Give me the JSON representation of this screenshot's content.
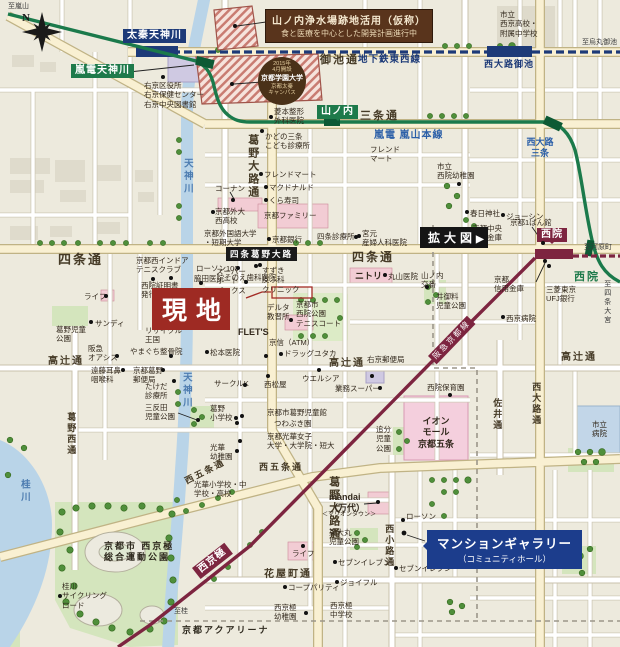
{
  "compass": {
    "n": "N"
  },
  "boxes": {
    "site": "現地",
    "enlarge_label": "拡大図",
    "enlarge_arrow": "▶",
    "intersection": "四条葛野大路",
    "info_line1": "山ノ内浄水場跡地活用（仮称）",
    "info_line2": "食と医療を中心とした開発計画進行中",
    "gallery_line1": "マンションギャラリー",
    "gallery_line2": "（コミュニティホール）"
  },
  "campus": {
    "l1": "2015年",
    "l2": "4月開設",
    "l3": "京都学園大学",
    "l4": "京都太秦",
    "l5": "キャンパス"
  },
  "lines": {
    "subway": "地下鉄東西線",
    "randen": "嵐電 嵐山本線",
    "hankyu": "阪急京都線"
  },
  "labels": [
    {
      "n": "dir-to-arashiyama",
      "t": "至嵐山",
      "x": 8,
      "y": 2,
      "c": "dir"
    },
    {
      "n": "station-uzumasa-tenjingawa",
      "t": "太秦天神川",
      "x": 123,
      "y": 29,
      "c": "station-navy"
    },
    {
      "n": "station-randen-tenjingawa",
      "t": "嵐電天神川",
      "x": 71,
      "y": 64,
      "c": "station-green"
    },
    {
      "n": "poi-ukyo-ward-office",
      "t": "右京区役所\n右京保健センター\n右京中央図書館",
      "x": 144,
      "y": 81,
      "c": "poi",
      "d": [
        163,
        77
      ]
    },
    {
      "n": "poi-saikyo-highschool",
      "t": "市立\n西京高校・\n附属中学校",
      "x": 500,
      "y": 10,
      "c": "poi"
    },
    {
      "n": "dir-to-karasuma-oike",
      "t": "至烏丸御池",
      "x": 582,
      "y": 38,
      "c": "dir"
    },
    {
      "n": "street-oike-dori",
      "t": "御池通",
      "x": 320,
      "y": 54,
      "c": "street",
      "s": 11
    },
    {
      "n": "rail-subway-tozai-label",
      "t": "地下鉄東西線",
      "x": 358,
      "y": 55,
      "c": "subway-text"
    },
    {
      "n": "station-nishioji-oike",
      "t": "西大路御池",
      "x": 484,
      "y": 59,
      "c": "subway-text",
      "s": 9
    },
    {
      "n": "street-sanjo-dori",
      "t": "三条通",
      "x": 360,
      "y": 110,
      "c": "street",
      "s": 11
    },
    {
      "n": "station-yamanouchi",
      "t": "山ノ内",
      "x": 317,
      "y": 105,
      "c": "station-green pt-down"
    },
    {
      "n": "rail-randen-line-label",
      "t": "嵐電 嵐山本線",
      "x": 374,
      "y": 130,
      "c": "rail-blue"
    },
    {
      "n": "station-nishioji-sanjo",
      "t": "西大路\n三条",
      "x": 520,
      "y": 137,
      "c": "blue2",
      "w": 40
    },
    {
      "n": "river-tenjingawa-upper",
      "t": "天神川",
      "x": 180,
      "y": 158,
      "c": "river",
      "v": 1
    },
    {
      "n": "poi-hishimoto-seikei",
      "t": "菱本整形\n外科医院",
      "x": 274,
      "y": 107,
      "c": "poi",
      "d": [
        271,
        117
      ]
    },
    {
      "n": "poi-kadono-sanjo-kids-clinic",
      "t": "かどの三条\nこども診療所",
      "x": 265,
      "y": 132,
      "c": "poi",
      "d": [
        262,
        131
      ]
    },
    {
      "n": "poi-friend-mart-1",
      "t": "フレンド\nマート",
      "x": 370,
      "y": 145,
      "c": "poi"
    },
    {
      "n": "poi-saiin-city-kindergarten",
      "t": "市立\n西院幼稚園",
      "x": 437,
      "y": 162,
      "c": "poi",
      "d": [
        459,
        184
      ]
    },
    {
      "n": "street-kadono-oji-upper",
      "t": "葛野大路通",
      "x": 245,
      "y": 134,
      "c": "street",
      "v": 1,
      "s": 11
    },
    {
      "n": "poi-konan",
      "t": "コーナン",
      "x": 215,
      "y": 184,
      "c": "poi",
      "d": [
        233,
        200
      ]
    },
    {
      "n": "poi-friend-mart-2",
      "t": "フレンドマート",
      "x": 264,
      "y": 170,
      "c": "poi",
      "d": [
        261,
        174
      ]
    },
    {
      "n": "poi-mcdonalds",
      "t": "マクドナルド",
      "x": 269,
      "y": 183,
      "c": "poi",
      "d": [
        266,
        187
      ]
    },
    {
      "n": "poi-kura-sushi",
      "t": "くら寿司",
      "x": 269,
      "y": 196,
      "c": "poi",
      "d": [
        266,
        200
      ]
    },
    {
      "n": "poi-kasuga-shrine",
      "t": "春日神社",
      "x": 470,
      "y": 209,
      "c": "poi",
      "d": [
        467,
        212
      ]
    },
    {
      "n": "poi-joshin",
      "t": "ジョーシン",
      "x": 506,
      "y": 212,
      "c": "poi",
      "d": [
        503,
        215
      ]
    },
    {
      "n": "poi-kyoto-family",
      "t": "京都ファミリー",
      "x": 264,
      "y": 211,
      "c": "poi"
    },
    {
      "n": "poi-kyoto-gaidai-nishi-hs",
      "t": "京都外大\n西高校",
      "x": 215,
      "y": 207,
      "c": "poi",
      "d": [
        213,
        212
      ]
    },
    {
      "n": "poi-kyoto-univ-foreign-studies",
      "t": "京都外国語大学\n・短期大学",
      "x": 204,
      "y": 229,
      "c": "poi"
    },
    {
      "n": "poi-kyoto-bank",
      "t": "京都銀行",
      "x": 272,
      "y": 235,
      "c": "poi",
      "d": [
        269,
        239
      ]
    },
    {
      "n": "poi-shijo-clinic",
      "t": "四条診療所",
      "x": 317,
      "y": 232,
      "c": "poi",
      "d": [
        356,
        237
      ]
    },
    {
      "n": "poi-miyamoto-maternity",
      "t": "宮元\n産婦人科医院",
      "x": 362,
      "y": 229,
      "c": "poi",
      "d": [
        359,
        236
      ]
    },
    {
      "n": "poi-kyoto-chuo-shinkin",
      "t": "京都中央\n信用金庫",
      "x": 472,
      "y": 224,
      "c": "poi"
    },
    {
      "n": "poi-kyoto-ichibankan",
      "t": "京都1ばん館",
      "x": 510,
      "y": 218,
      "c": "poi",
      "d": [
        543,
        243
      ]
    },
    {
      "n": "street-shijo-dori-west",
      "t": "四条通",
      "x": 58,
      "y": 252,
      "c": "street",
      "s": 13
    },
    {
      "n": "street-shijo-dori-east",
      "t": "四条通",
      "x": 352,
      "y": 250,
      "c": "street",
      "s": 12
    },
    {
      "n": "dir-to-kawaramachi",
      "t": "至河原町",
      "x": 584,
      "y": 243,
      "c": "dir"
    },
    {
      "n": "station-saiin-hankyu",
      "t": "西院",
      "x": 537,
      "y": 228,
      "c": "station-maroon pt-down"
    },
    {
      "n": "station-saiin-randen",
      "t": "西院",
      "x": 574,
      "y": 271,
      "c": "green-text"
    },
    {
      "n": "dir-to-shijo-omiya",
      "t": "至四条大宮",
      "x": 603,
      "y": 280,
      "c": "dir",
      "v": 1
    },
    {
      "n": "poi-lawson-100",
      "t": "ローソン100",
      "x": 196,
      "y": 264,
      "c": "poi",
      "d": [
        238,
        268
      ]
    },
    {
      "n": "poi-wakita-clinic",
      "t": "脇田医院",
      "x": 194,
      "y": 274,
      "c": "poi",
      "d": [
        201,
        283
      ]
    },
    {
      "n": "poi-sonoe-dental",
      "t": "そのえ歯科医院",
      "x": 224,
      "y": 273,
      "c": "poi",
      "d": [
        246,
        282
      ]
    },
    {
      "n": "poi-kyoto-west-indoor-tennis",
      "t": "京都西インドア\nテニスクラブ",
      "x": 136,
      "y": 256,
      "c": "poi",
      "d": [
        171,
        278
      ]
    },
    {
      "n": "poi-saiin-certificate-corner",
      "t": "西院証明書\n発行コーナー",
      "x": 141,
      "y": 281,
      "c": "poi",
      "d": [
        153,
        279
      ]
    },
    {
      "n": "poi-super-autobacs",
      "t": "スーパー\nオート\nバックス",
      "x": 216,
      "y": 267,
      "c": "poi",
      "d": [
        256,
        266
      ]
    },
    {
      "n": "poi-suzuki-dermatology",
      "t": "すずき\n皮ふ科\nクリニック",
      "x": 262,
      "y": 266,
      "c": "poi",
      "d": [
        260,
        265
      ]
    },
    {
      "n": "poi-nitori",
      "t": "ニトリ",
      "x": 355,
      "y": 271,
      "c": "poi-big"
    },
    {
      "n": "poi-maruyama-clinic",
      "t": "丸山医院",
      "x": 388,
      "y": 272,
      "c": "poi",
      "d": [
        385,
        275
      ]
    },
    {
      "n": "poi-yamanouchi-koban",
      "t": "山ノ内\n交番",
      "x": 421,
      "y": 271,
      "c": "poi",
      "d": [
        427,
        287
      ]
    },
    {
      "n": "poi-life-1",
      "t": "ライフ",
      "x": 84,
      "y": 292,
      "c": "poi",
      "d": [
        106,
        296
      ]
    },
    {
      "n": "poi-sandy",
      "t": "サンディ",
      "x": 95,
      "y": 319,
      "c": "poi",
      "d": [
        91,
        322
      ]
    },
    {
      "n": "poi-kadono-jido-park",
      "t": "葛野児童\n公園",
      "x": 56,
      "y": 325,
      "c": "poi"
    },
    {
      "n": "poi-recycle-kingdom",
      "t": "リサイクル\n王国",
      "x": 145,
      "y": 326,
      "c": "poi"
    },
    {
      "n": "poi-delta-driving-school",
      "t": "デルタ\n教習所",
      "x": 267,
      "y": 303,
      "c": "poi"
    },
    {
      "n": "poi-saiin-park-tennis-court",
      "t": "京都市\n西院公園\nテニスコート",
      "x": 296,
      "y": 300,
      "c": "poi"
    },
    {
      "n": "poi-igoryo-jido-park",
      "t": "井御料\n児童公園",
      "x": 436,
      "y": 292,
      "c": "poi"
    },
    {
      "n": "poi-kyoto-shinkin",
      "t": "京都\n信用金庫",
      "x": 494,
      "y": 275,
      "c": "poi",
      "d": [
        545,
        261
      ]
    },
    {
      "n": "poi-mufg-bank",
      "t": "三菱東京\nUFJ銀行",
      "x": 546,
      "y": 285,
      "c": "poi",
      "d": [
        549,
        266
      ]
    },
    {
      "n": "poi-saikyo-hospital",
      "t": "西京病院",
      "x": 506,
      "y": 314,
      "c": "poi",
      "d": [
        503,
        317
      ]
    },
    {
      "n": "poi-flets",
      "t": "FLET'S",
      "x": 238,
      "y": 327,
      "c": "poi-big",
      "d": [
        291,
        320
      ]
    },
    {
      "n": "poi-matsumoto-clinic",
      "t": "松本医院",
      "x": 210,
      "y": 348,
      "c": "poi",
      "d": [
        207,
        352
      ]
    },
    {
      "n": "poi-hankyu-oasis",
      "t": "阪急\nオアシス",
      "x": 88,
      "y": 344,
      "c": "poi",
      "d": [
        117,
        356
      ]
    },
    {
      "n": "poi-yamaguchi-seikotsuin",
      "t": "やまぐち整骨院",
      "x": 130,
      "y": 347,
      "c": "poi",
      "d": [
        171,
        356
      ]
    },
    {
      "n": "street-takatsuji-west",
      "t": "高辻通",
      "x": 48,
      "y": 356,
      "c": "street",
      "s": 10
    },
    {
      "n": "poi-endo-ent-clinic",
      "t": "遠藤耳鼻\n咽喉科",
      "x": 91,
      "y": 366,
      "c": "poi",
      "d": [
        123,
        370
      ]
    },
    {
      "n": "poi-kadono-post-office",
      "t": "京都葛野\n郵便局",
      "x": 133,
      "y": 366,
      "c": "poi",
      "d": [
        163,
        370
      ]
    },
    {
      "n": "poi-takeda-clinic",
      "t": "たけだ\n診療所",
      "x": 145,
      "y": 382,
      "c": "poi",
      "d": [
        174,
        381
      ]
    },
    {
      "n": "poi-santanda-jido-park",
      "t": "三反田\n児童公園",
      "x": 145,
      "y": 403,
      "c": "poi",
      "d": [
        198,
        420
      ]
    },
    {
      "n": "street-kadononishi-dori",
      "t": "葛野西通",
      "x": 65,
      "y": 412,
      "c": "street",
      "v": 1,
      "s": 9
    },
    {
      "n": "river-tenjingawa-lower",
      "t": "天神川",
      "x": 179,
      "y": 372,
      "c": "river",
      "v": 1
    },
    {
      "n": "poi-keishin-atm",
      "t": "京信（ATM）",
      "x": 269,
      "y": 338,
      "c": "poi",
      "d": [
        266,
        356
      ]
    },
    {
      "n": "poi-drug-yutaka",
      "t": "ドラッグユタカ",
      "x": 284,
      "y": 349,
      "c": "poi",
      "d": [
        281,
        354
      ]
    },
    {
      "n": "street-takatsuji-center",
      "t": "高辻通",
      "x": 329,
      "y": 358,
      "c": "street",
      "s": 10
    },
    {
      "n": "poi-ukyo-post-office",
      "t": "右京郵便局",
      "x": 367,
      "y": 355,
      "c": "poi",
      "d": [
        372,
        376
      ]
    },
    {
      "n": "poi-circle-k",
      "t": "サークルK",
      "x": 214,
      "y": 379,
      "c": "poi",
      "d": [
        245,
        385
      ]
    },
    {
      "n": "poi-nishimatsuya",
      "t": "西松屋",
      "x": 264,
      "y": 380,
      "c": "poi",
      "d": [
        268,
        376
      ]
    },
    {
      "n": "poi-welcia",
      "t": "ウエルシア",
      "x": 302,
      "y": 374,
      "c": "poi",
      "d": [
        319,
        370
      ]
    },
    {
      "n": "poi-gyomu-super",
      "t": "業務スーパー",
      "x": 335,
      "y": 384,
      "c": "poi",
      "d": [
        380,
        388
      ]
    },
    {
      "n": "street-takatsuji-east",
      "t": "高辻通",
      "x": 561,
      "y": 352,
      "c": "street",
      "s": 10
    },
    {
      "n": "poi-saiin-hoikuen",
      "t": "西院保育園",
      "x": 427,
      "y": 383,
      "c": "poi",
      "d": [
        450,
        395
      ]
    },
    {
      "n": "street-sai-dori",
      "t": "佐井通",
      "x": 491,
      "y": 398,
      "c": "street",
      "v": 1,
      "s": 9
    },
    {
      "n": "street-nishioji-dori",
      "t": "西大路通",
      "x": 530,
      "y": 382,
      "c": "street",
      "v": 1,
      "s": 9
    },
    {
      "n": "poi-kadono-elementary",
      "t": "葛野\n小学校",
      "x": 210,
      "y": 404,
      "c": "poi",
      "d": [
        236,
        418
      ]
    },
    {
      "n": "poi-kadono-jidokan",
      "t": "京都市葛野児童館",
      "x": 267,
      "y": 408,
      "c": "poi",
      "d": [
        242,
        416
      ]
    },
    {
      "n": "poi-tsuwabuki-en",
      "t": "つわぶき園",
      "x": 274,
      "y": 419,
      "c": "poi",
      "d": [
        237,
        423
      ]
    },
    {
      "n": "poi-koka-womens-univ",
      "t": "京都光華女子\n大学・大学院・短大",
      "x": 267,
      "y": 432,
      "c": "poi",
      "d": [
        240,
        441
      ]
    },
    {
      "n": "poi-koka-kindergarten",
      "t": "光華\n幼稚園",
      "x": 210,
      "y": 443,
      "c": "poi",
      "d": [
        237,
        451
      ]
    },
    {
      "n": "poi-oiwake-jido-park",
      "t": "追分\n児童\n公園",
      "x": 376,
      "y": 425,
      "c": "poi"
    },
    {
      "n": "poi-aeon-mall-kyoto-gojo",
      "t": "イオン\nモール\n京都五条",
      "x": 414,
      "y": 416,
      "c": "poi-big",
      "w": 44
    },
    {
      "n": "poi-city-hospital",
      "t": "市立\n病院",
      "x": 592,
      "y": 420,
      "c": "poi"
    },
    {
      "n": "street-nishigojo-east",
      "t": "西五条通",
      "x": 259,
      "y": 462,
      "c": "street",
      "s": 9
    },
    {
      "n": "street-nishigojo-diagonal",
      "t": "西五条通",
      "x": 183,
      "y": 477,
      "c": "street",
      "s": 9,
      "r": -27
    },
    {
      "n": "river-katsuragawa",
      "t": "桂川",
      "x": 17,
      "y": 479,
      "c": "river",
      "v": 1
    },
    {
      "n": "poi-koka-schools",
      "t": "光華小学校・中\n学校・高校",
      "x": 194,
      "y": 480,
      "c": "poi"
    },
    {
      "n": "street-kadono-oji-lower",
      "t": "葛野大路通",
      "x": 326,
      "y": 476,
      "c": "street",
      "v": 1,
      "s": 11
    },
    {
      "n": "poi-mandai",
      "t": "mandai\n（万代）",
      "x": 329,
      "y": 492,
      "c": "poi-big",
      "d": [
        378,
        502
      ]
    },
    {
      "n": "poi-marion-town",
      "t": "＜マリオンタウン＞",
      "x": 322,
      "y": 512,
      "c": "poi",
      "s": 6
    },
    {
      "n": "poi-higashi-omaru-park",
      "t": "東大丸\n児童公園",
      "x": 329,
      "y": 528,
      "c": "poi"
    },
    {
      "n": "poi-lawson",
      "t": "ローソン",
      "x": 406,
      "y": 512,
      "c": "poi",
      "d": [
        403,
        520
      ]
    },
    {
      "n": "street-nishikoji-dori",
      "t": "西小路通",
      "x": 383,
      "y": 524,
      "c": "street",
      "v": 1,
      "s": 9
    },
    {
      "n": "station-nishikyogoku",
      "t": "西京極",
      "x": 192,
      "y": 568,
      "c": "station-maroon",
      "r": -38
    },
    {
      "n": "poi-nishikyogoku-sports-park",
      "t": "京都市 西京極\n総合運動公園",
      "x": 104,
      "y": 541,
      "c": "park-name"
    },
    {
      "n": "poi-life-2",
      "t": "ライフ",
      "x": 292,
      "y": 549,
      "c": "poi",
      "d": [
        303,
        546
      ]
    },
    {
      "n": "poi-seven-eleven-1",
      "t": "セブンイレブン",
      "x": 338,
      "y": 558,
      "c": "poi",
      "d": [
        335,
        562
      ]
    },
    {
      "n": "poi-seven-eleven-2",
      "t": "セブンイレブン",
      "x": 399,
      "y": 564,
      "c": "poi",
      "d": [
        396,
        568
      ]
    },
    {
      "n": "street-hanayacho-dori",
      "t": "花屋町通",
      "x": 264,
      "y": 569,
      "c": "street",
      "s": 10
    },
    {
      "n": "poi-joyful",
      "t": "ジョイフル",
      "x": 340,
      "y": 578,
      "c": "poi",
      "d": [
        337,
        582
      ]
    },
    {
      "n": "poi-coop-parity",
      "t": "コープパリティ",
      "x": 288,
      "y": 583,
      "c": "poi",
      "d": [
        285,
        587
      ]
    },
    {
      "n": "poi-katsura-cycling-road",
      "t": "桂川\nサイクリング\nロード",
      "x": 62,
      "y": 582,
      "c": "poi",
      "d": [
        60,
        596
      ]
    },
    {
      "n": "poi-nishikyogoku-kindergarten",
      "t": "西京極\n幼稚園",
      "x": 274,
      "y": 603,
      "c": "poi",
      "d": [
        306,
        613
      ]
    },
    {
      "n": "poi-nishikyogoku-jhs",
      "t": "西京極\n中学校",
      "x": 330,
      "y": 601,
      "c": "poi"
    },
    {
      "n": "dir-to-katsura",
      "t": "至桂",
      "x": 174,
      "y": 607,
      "c": "dir"
    },
    {
      "n": "poi-kyoto-aquarena",
      "t": "京都アクアリーナ",
      "x": 182,
      "y": 625,
      "c": "park-name"
    },
    {
      "n": "rail-hankyu-line-label",
      "t": "阪急京都線",
      "x": 428,
      "y": 356,
      "c": "hankyu-text",
      "r": -46
    }
  ]
}
